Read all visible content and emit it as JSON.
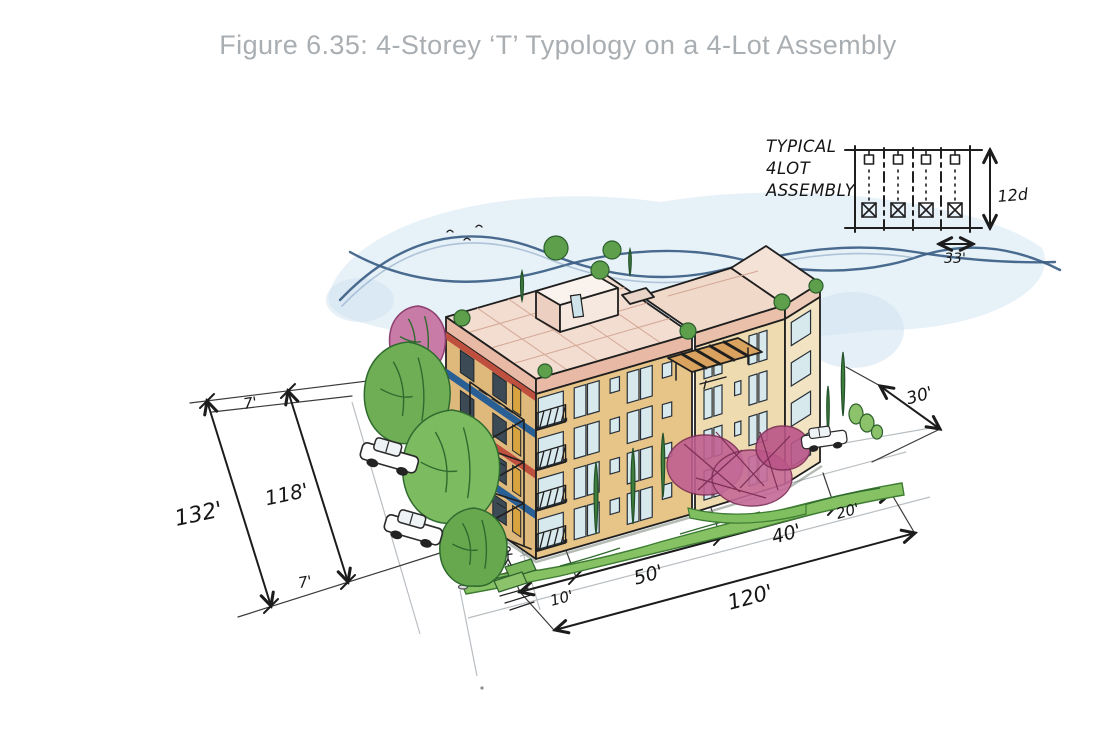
{
  "caption": {
    "text": "Figure 6.35: 4-Storey ‘T’ Typology on a 4-Lot Assembly"
  },
  "inset": {
    "title_line1": "TYPICAL",
    "title_line2": "4LOT",
    "title_line3": "ASSEMBLY",
    "depth_label": "12d",
    "lot_width_label": "33'"
  },
  "dims": {
    "setback_top": "7'",
    "assembly_width_total": "132'",
    "assembly_width_inner": "118'",
    "setback_bottom": "7'",
    "front_offset": "10'",
    "segment_50": "50'",
    "segment_40": "40'",
    "segment_20": "20'",
    "depth_total": "120'",
    "rear_yard": "30'"
  },
  "colors": {
    "caption_gray": "#a9aeb2",
    "ink": "#1c1c1c",
    "building_tan": "#e7c488",
    "roof_pink": "#f3ddd0",
    "parapet_pink": "#e8b9a4",
    "stripe_blue": "#2a5f95",
    "stripe_red": "#bf4f3e",
    "foliage_green": "#6fae55",
    "conifer_green": "#3f7d3c",
    "blossom_pink": "#c06090",
    "sky_blue": "#d7e8f3",
    "wave_blue": "#3c5e86",
    "glass_blue": "#d8e9ee"
  }
}
